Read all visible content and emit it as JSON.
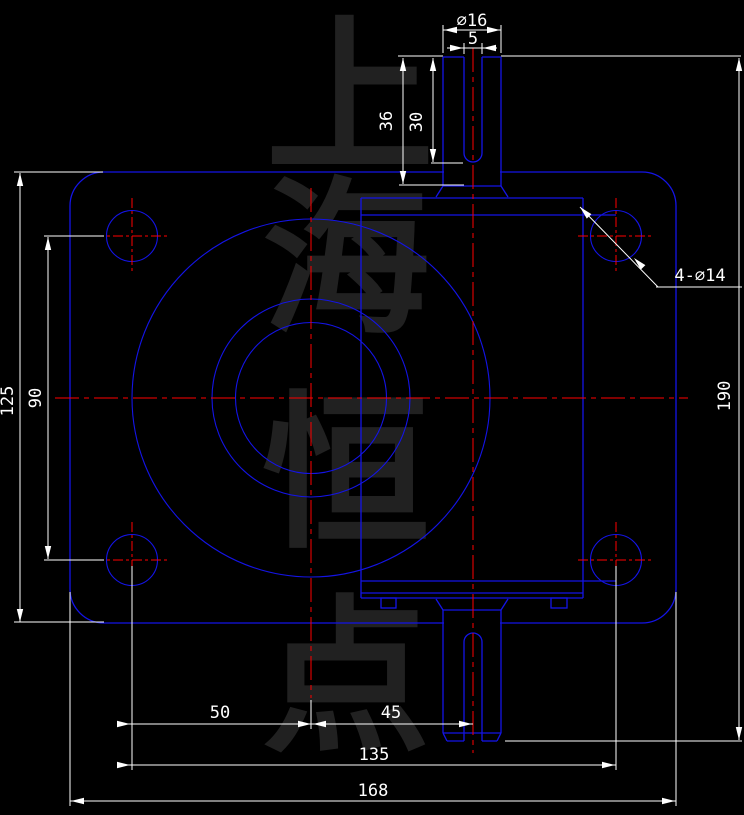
{
  "watermark": {
    "text": "上海恒点",
    "chars": [
      "上",
      "海",
      "恒",
      "点"
    ]
  },
  "dimensions": {
    "shaft_diameter": "∅16",
    "keyway_width": "5",
    "shaft_length": "36",
    "keyway_length": "30",
    "mounting_holes_callout": "4-∅14",
    "body_height": "125",
    "hole_spacing_vertical": "90",
    "overall_height": "190",
    "hole_to_center": "50",
    "center_to_shaft": "45",
    "hole_spacing_horizontal": "135",
    "overall_width": "168"
  },
  "colors": {
    "background": "#000000",
    "outline_blue": "#1414e6",
    "dimension_white": "#ffffff",
    "centerline_red": "#ff0000",
    "watermark_gray": "#212121"
  }
}
